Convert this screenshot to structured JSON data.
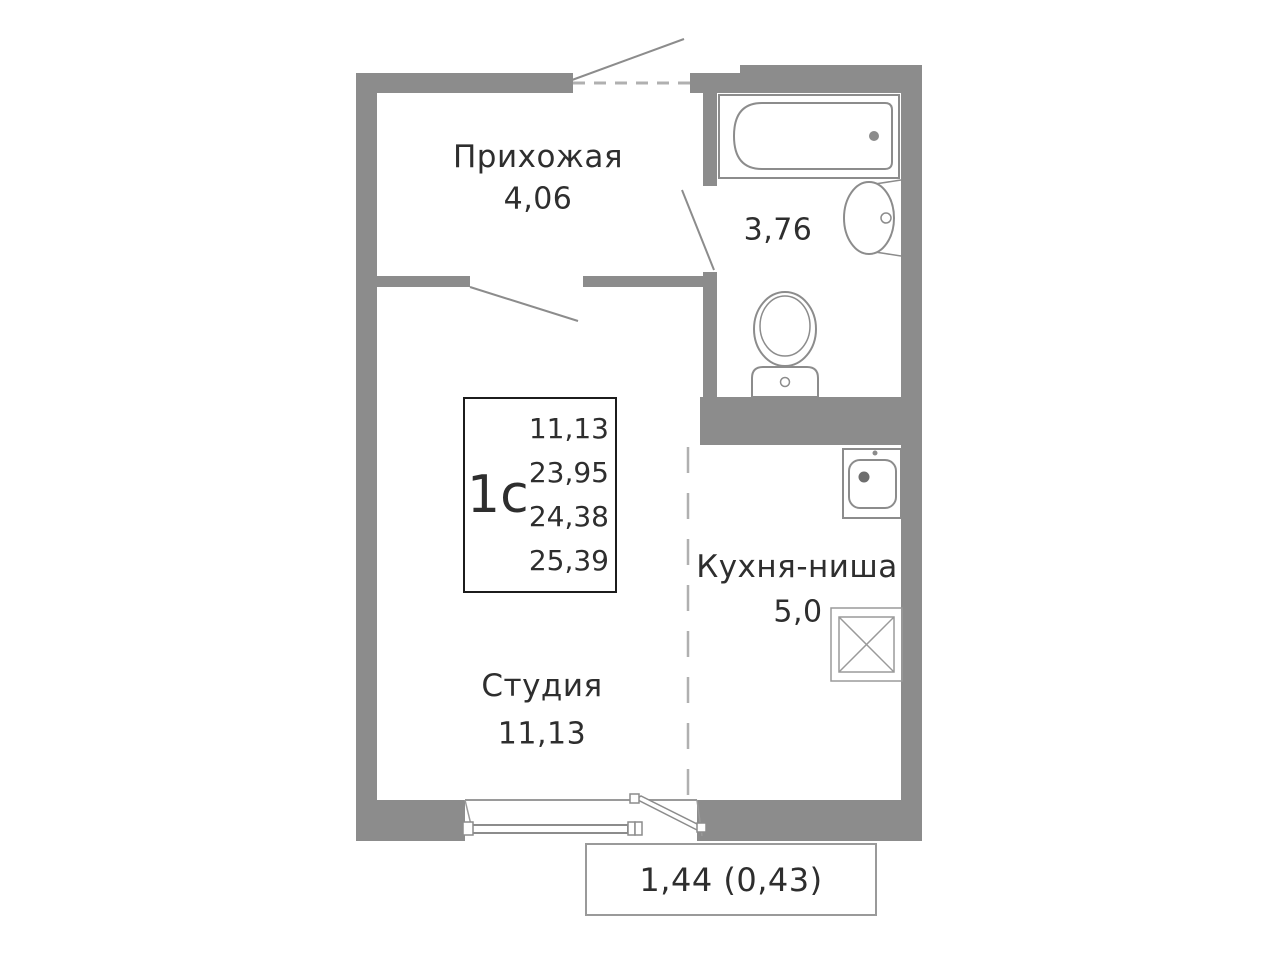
{
  "unit_card": {
    "type_label": "1с",
    "areas": [
      "11,13",
      "23,95",
      "24,38",
      "25,39"
    ]
  },
  "rooms": {
    "hallway": {
      "name": "Прихожая",
      "area": "4,06"
    },
    "bathroom": {
      "area": "3,76"
    },
    "kitchen": {
      "name": "Кухня-ниша",
      "area": "5,0"
    },
    "studio": {
      "name": "Студия",
      "area": "11,13"
    },
    "balcony": {
      "area": "1,44 (0,43)"
    }
  },
  "fixtures": [
    "bathtub",
    "washbasin",
    "toilet",
    "kitchen-sink",
    "stove-hob",
    "window",
    "balcony-door",
    "entrance-door"
  ],
  "colors": {
    "wall": "#8c8c8c",
    "line": "#8c8c8c",
    "line_light": "#9a9a9a",
    "dashed": "#b0b0b0",
    "text": "#2e2e2e",
    "box_border": "#1c1c1c"
  }
}
